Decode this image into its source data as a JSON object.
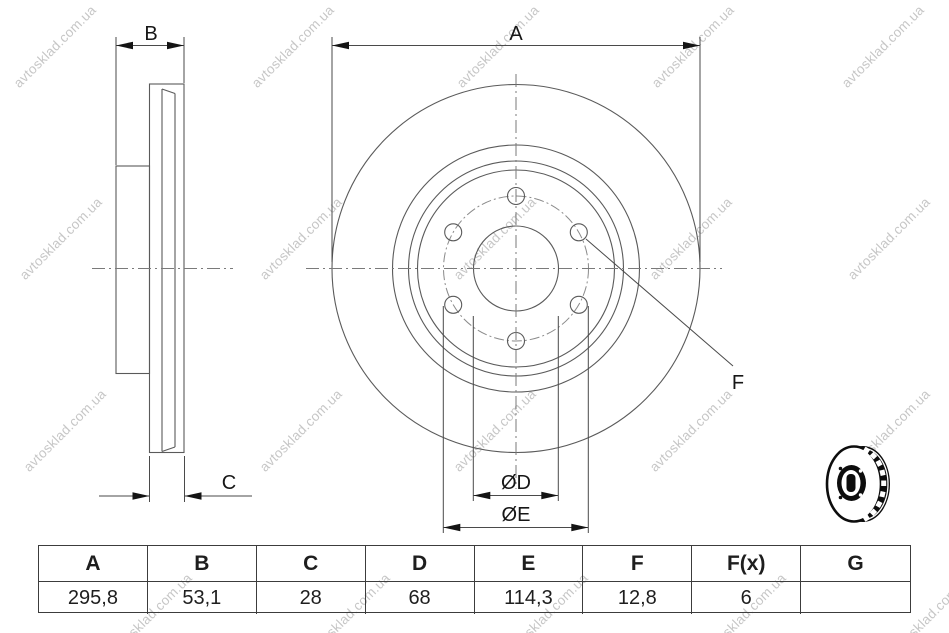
{
  "watermark": {
    "text": "avtosklad.com.ua"
  },
  "drawing": {
    "title": "vented-brake-disc-two-view-drawing",
    "labels": {
      "A": "A",
      "B": "B",
      "C": "C",
      "D": "ØD",
      "E": "ØE",
      "F": "F"
    }
  },
  "icons": {
    "product": "brake-disc-3d"
  },
  "table": {
    "headers": [
      "A",
      "B",
      "C",
      "D",
      "E",
      "F",
      "F(x)",
      "G"
    ],
    "values": [
      "295,8",
      "53,1",
      "28",
      "68",
      "114,3",
      "12,8",
      "6",
      ""
    ]
  },
  "colors": {
    "background": "#ffffff",
    "drawing_line": "#5a5a5a",
    "dimension_line": "#4a4a4a",
    "text": "#161616",
    "table_border": "#3c3c3c",
    "watermark": "#9e9e9e"
  }
}
